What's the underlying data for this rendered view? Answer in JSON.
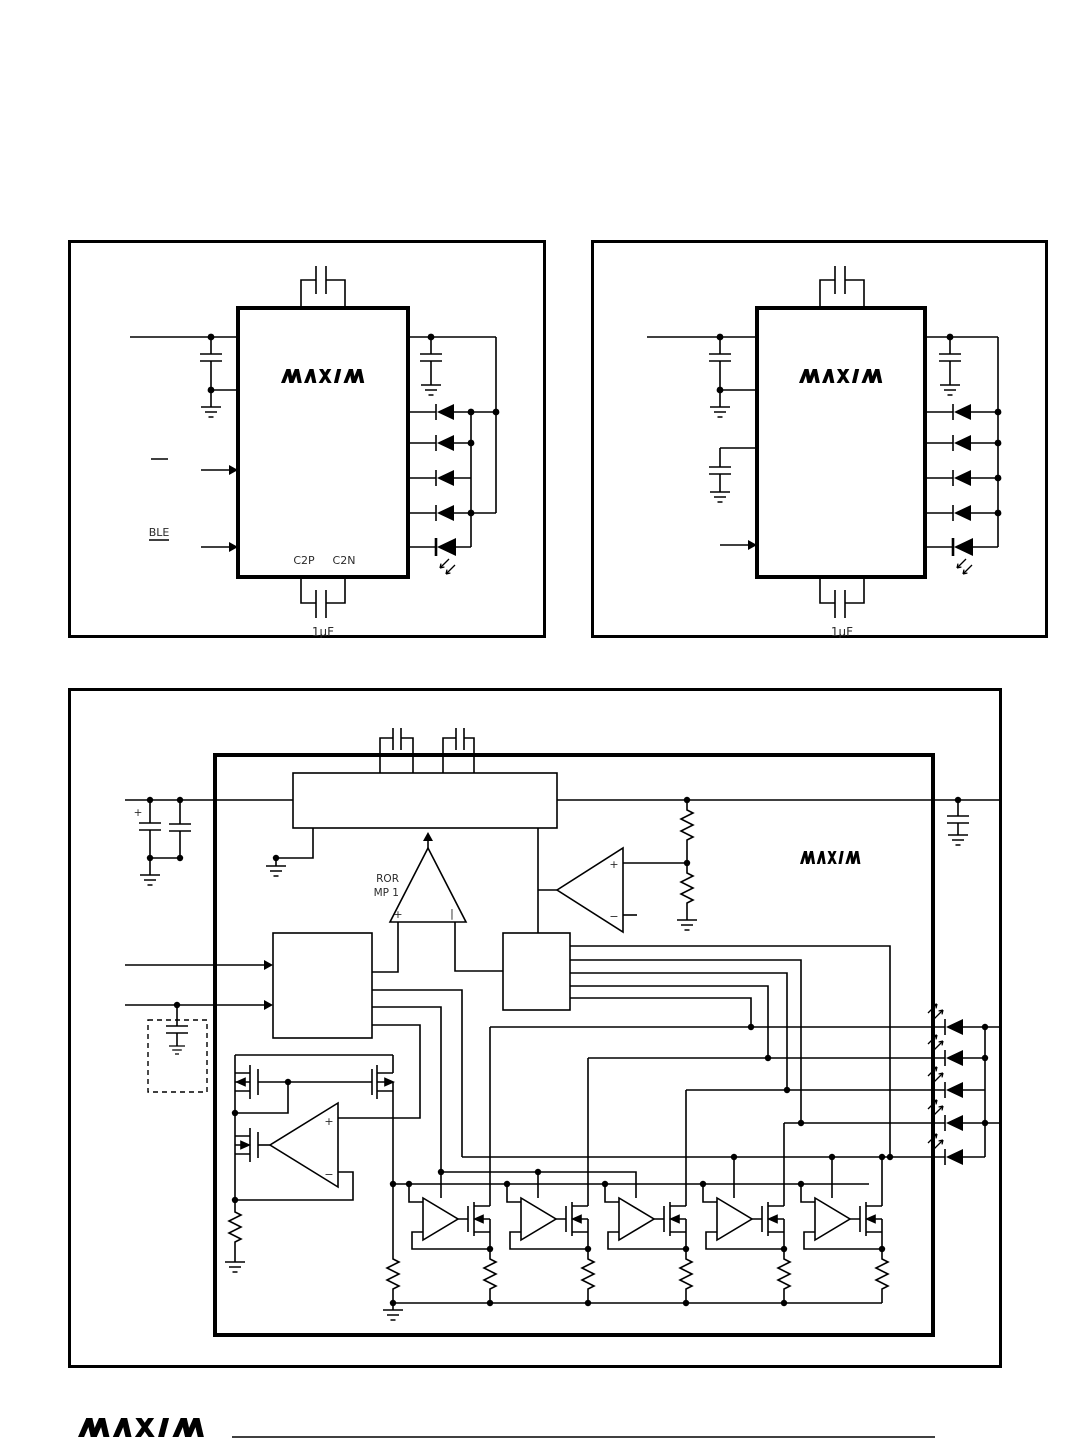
{
  "brand": {
    "logo_text": "MAXIM"
  },
  "colors": {
    "ink": "#000000",
    "paper": "#ffffff",
    "label": "#2b2b2b"
  },
  "fig_top_left": {
    "labels": {
      "input2": "BLE",
      "pin_c2p": "C2P",
      "pin_c2n": "C2N",
      "cap_value": "1µF"
    }
  },
  "fig_top_right": {
    "labels": {
      "cap_value": "1µF"
    }
  },
  "fig_functional": {
    "labels": {
      "err_line1": "ROR",
      "err_line2": "MP 1",
      "err_plus": "+",
      "err_minus": "|",
      "opamp_plus": "+",
      "opamp_minus": "−",
      "comp_plus": "+",
      "comp_minus": "−",
      "cap_plus": "+"
    }
  }
}
